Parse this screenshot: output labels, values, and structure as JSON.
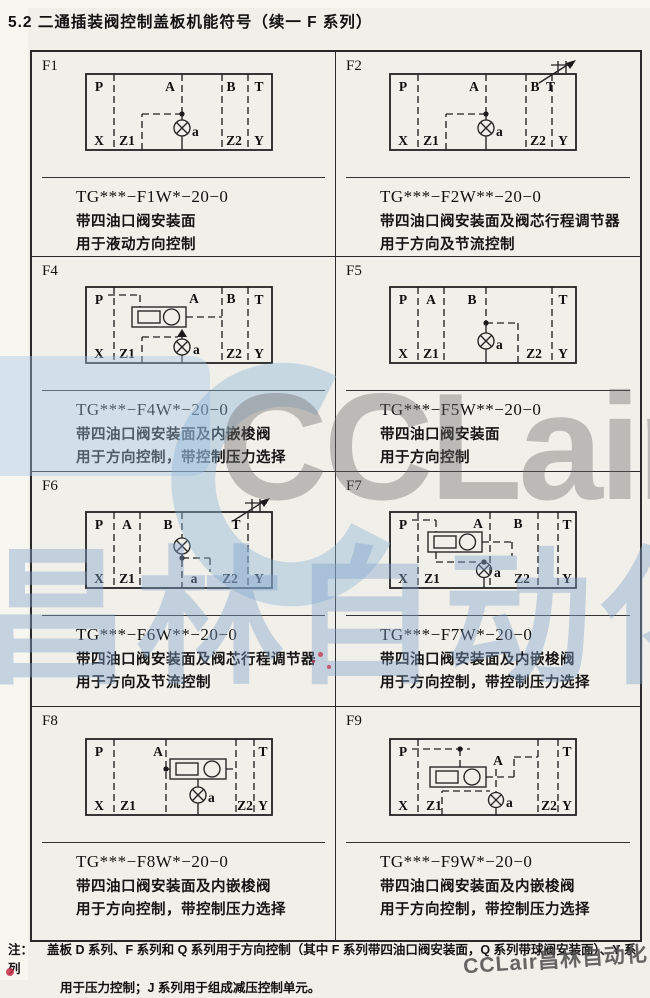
{
  "page": {
    "title": "5.2 二通插装阀控制盖板机能符号（续一 F 系列）"
  },
  "cells": [
    {
      "id": "F1",
      "model": "TG***−F1W*−20−0",
      "desc": [
        "带四油口阀安装面",
        "用于液动方向控制"
      ],
      "ports": {
        "P": "P",
        "A": "A",
        "B": "B",
        "T": "T",
        "X": "X",
        "Z1": "Z1",
        "Z2": "Z2",
        "Y": "Y",
        "a": "a"
      }
    },
    {
      "id": "F2",
      "model": "TG***−F2W**−20−0",
      "desc": [
        "带四油口阀安装面及阀芯行程调节器",
        "用于方向及节流控制"
      ],
      "ports": {
        "P": "P",
        "A": "A",
        "B": "B",
        "T": "T",
        "X": "X",
        "Z1": "Z1",
        "Z2": "Z2",
        "Y": "Y",
        "a": "a"
      }
    },
    {
      "id": "F4",
      "model": "TG***−F4W*−20−0",
      "desc": [
        "带四油口阀安装面及内嵌梭阀",
        "用于方向控制，带控制压力选择"
      ],
      "ports": {
        "P": "P",
        "A": "A",
        "B": "B",
        "T": "T",
        "X": "X",
        "Z1": "Z1",
        "Z2": "Z2",
        "Y": "Y",
        "a": "a"
      }
    },
    {
      "id": "F5",
      "model": "TG***−F5W**−20−0",
      "desc": [
        "带四油口阀安装面",
        "用于方向控制"
      ],
      "ports": {
        "P": "P",
        "A": "A",
        "B": "B",
        "T": "T",
        "X": "X",
        "Z1": "Z1",
        "Z2": "Z2",
        "Y": "Y",
        "a": "a"
      }
    },
    {
      "id": "F6",
      "model": "TG***−F6W**−20−0",
      "desc": [
        "带四油口阀安装面及阀芯行程调节器",
        "用于方向及节流控制"
      ],
      "ports": {
        "P": "P",
        "A": "A",
        "B": "B",
        "T": "T",
        "X": "X",
        "Z1": "Z1",
        "a": "a",
        "Z2": "Z2",
        "Y": "Y"
      }
    },
    {
      "id": "F7",
      "model": "TG***−F7W*−20−0",
      "desc": [
        "带四油口阀安装面及内嵌梭阀",
        "用于方向控制，带控制压力选择"
      ],
      "ports": {
        "P": "P",
        "A": "A",
        "B": "B",
        "T": "T",
        "X": "X",
        "Z1": "Z1",
        "Z2": "Z2",
        "Y": "Y",
        "a": "a"
      }
    },
    {
      "id": "F8",
      "model": "TG***−F8W*−20−0",
      "desc": [
        "带四油口阀安装面及内嵌梭阀",
        "用于方向控制，带控制压力选择"
      ],
      "ports": {
        "P": "P",
        "A": "A",
        "T": "T",
        "X": "X",
        "Z1": "Z1",
        "Z2": "Z2",
        "Y": "Y",
        "a": "a"
      }
    },
    {
      "id": "F9",
      "model": "TG***−F9W*−20−0",
      "desc": [
        "带四油口阀安装面及内嵌梭阀",
        "用于方向控制，带控制压力选择"
      ],
      "ports": {
        "P": "P",
        "A": "A",
        "T": "T",
        "X": "X",
        "Z1": "Z1",
        "Z2": "Z2",
        "Y": "Y",
        "a": "a"
      }
    }
  ],
  "note": {
    "label": "注：",
    "line1": "盖板 D 系列、F 系列和 Q 系列用于方向控制（其中 F 系列带四油口阀安装面，Q 系列带球阀安装面）、Y 系列",
    "line2": "用于压力控制；J 系列用于组成减压控制单元。"
  },
  "watermark": {
    "logo": "CCLair",
    "cn": "昌林自动化",
    "footer": "CCLair昌林自动化"
  },
  "colors": {
    "ink": "#1f1f1f",
    "paper": "#f1efe9",
    "border": "#2a2a2a",
    "watermark_gray": "#8c8c8c",
    "watermark_blue": "#a9c6e2",
    "stray_red": "#c62f48"
  }
}
